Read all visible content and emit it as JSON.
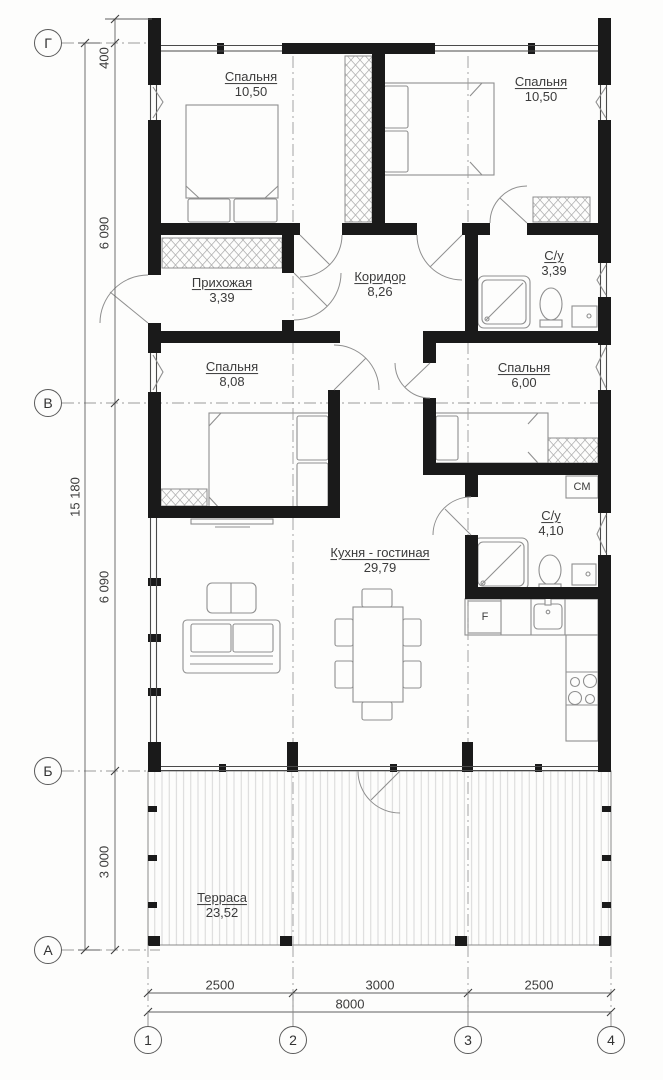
{
  "plan": {
    "title": "one-storey house floor plan",
    "rooms": [
      {
        "name": "Спальня",
        "area": "10,50"
      },
      {
        "name": "Спальня",
        "area": "10,50"
      },
      {
        "name": "Прихожая",
        "area": "3,39"
      },
      {
        "name": "Коридор",
        "area": "8,26"
      },
      {
        "name": "С/у",
        "area": "3,39"
      },
      {
        "name": "Спальня",
        "area": "8,08"
      },
      {
        "name": "Спальня",
        "area": "6,00"
      },
      {
        "name": "С/у",
        "area": "4,10"
      },
      {
        "name": "Кухня - гостиная",
        "area": "29,79"
      },
      {
        "name": "Терраса",
        "area": "23,52"
      }
    ],
    "appliance_labels": {
      "washing_machine": "СМ",
      "fridge": "F"
    },
    "axes": {
      "rows": [
        "Г",
        "В",
        "Б",
        "А"
      ],
      "columns": [
        "1",
        "2",
        "3",
        "4"
      ]
    },
    "dimensions": {
      "left_segments": [
        "400",
        "6 090",
        "6 090",
        "3 000"
      ],
      "left_total": "15 180",
      "bottom_segments": [
        "2500",
        "3000",
        "2500"
      ],
      "bottom_total": "8000"
    },
    "colors": {
      "walls": "#1a1a1a",
      "thin_lines": "#6e6e6e",
      "furniture": "#8f8f8f"
    }
  }
}
